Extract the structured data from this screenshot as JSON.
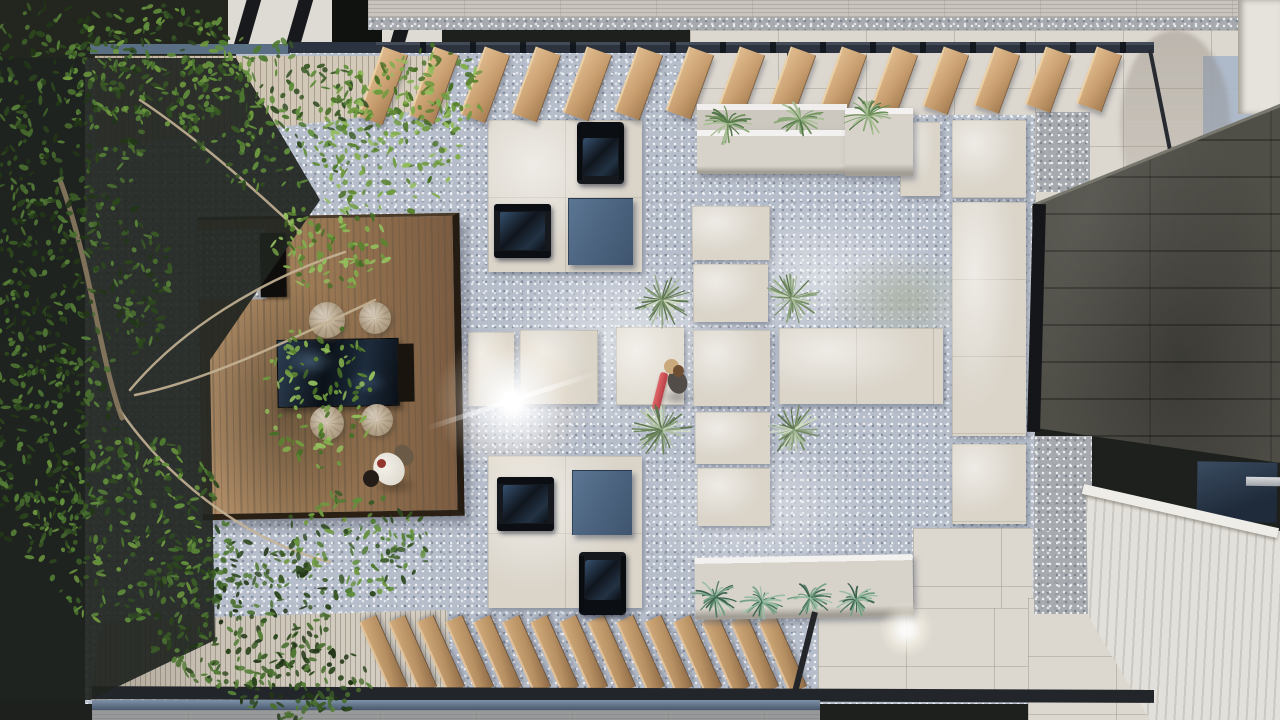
{
  "scene": {
    "type": "architectural-render-top-down",
    "description": "Aerial view of a modern courtyard: wooden dining deck under a large tree, blue-gray gravel garden with concrete pavers, two louvered pergolas, planter benches with ornamental grasses, yucca shrubs, a dark stone roof and white plank ramp on the right, two people.",
    "people": [
      {
        "id": "person-on-deck",
        "appearance": "white long-sleeve top, dark hair, olive trousers",
        "location": "walking on wooden deck"
      },
      {
        "id": "person-on-path",
        "appearance": "dark top, light sun hat, carrying a red rolled mat",
        "location": "standing on central paver path"
      }
    ],
    "furniture": {
      "deck_table": "dark reflective low dining table",
      "pouf_count": 4,
      "lounge_chair_count": 2,
      "club_chair_count": 2,
      "slate_side_table_count": 2,
      "bench_count": 2
    }
  },
  "palette": {
    "underDark": "#1d201c",
    "gravel": "#b7becb",
    "gravelDark": "#a6a9ad",
    "paver": "#dad4c9",
    "tile": "#dcd7cf",
    "tileBlue": "#a9b6c8",
    "tileBlue2": "#9dafc6",
    "woodDeckL": "#b28f69",
    "woodDeckD": "#7c5c41",
    "woodSlat": "#cda87c",
    "woodPale": "#cfc4b2",
    "deckGray": "#c9c2b5",
    "steel": "#2f3642",
    "beamDark": "#22252a",
    "roof": "#4f4e47",
    "navy": "#101b26",
    "slateTable": "#4e6682",
    "pouf": "#c3b299",
    "bench": "#d7d3cb",
    "white": "#e6e3dd",
    "glassBlue": "#6d8099",
    "shirt": "#ece8e1",
    "redItem": "#cc4f55"
  },
  "pergola_top": {
    "slat_count": 15,
    "lean_deg": 20,
    "x": 382,
    "y": 51,
    "spacing": 51,
    "width": 27,
    "len0": 74,
    "dlen": 1.0
  },
  "pergola_bottom": {
    "slat_count": 15,
    "lean_deg": -24,
    "x": 390,
    "y": 690,
    "spacing": 28.5,
    "width": 19,
    "len": 78
  },
  "poufs": [
    [
      327,
      320,
      18
    ],
    [
      375,
      318,
      16
    ],
    [
      327,
      423,
      17
    ],
    [
      377,
      420,
      16
    ]
  ],
  "vegetation": {
    "yuccas": [
      [
        662,
        300,
        30
      ],
      [
        792,
        298,
        27
      ],
      [
        662,
        430,
        30
      ],
      [
        794,
        430,
        27
      ]
    ],
    "grass_top": [
      [
        728,
        124,
        26
      ],
      [
        800,
        120,
        26
      ],
      [
        868,
        116,
        26
      ]
    ],
    "grass_bottom": [
      [
        715,
        598,
        24
      ],
      [
        762,
        602,
        24
      ],
      [
        810,
        598,
        24
      ],
      [
        856,
        600,
        22
      ]
    ],
    "foliage_clusters": [
      [
        55,
        115,
        95,
        115,
        260,
        "dark"
      ],
      [
        160,
        65,
        95,
        60,
        200,
        "mid"
      ],
      [
        275,
        115,
        95,
        75,
        200,
        "mid"
      ],
      [
        390,
        140,
        70,
        80,
        130,
        "sun"
      ],
      [
        75,
        285,
        100,
        95,
        260,
        "dark"
      ],
      [
        35,
        440,
        85,
        105,
        240,
        "dark"
      ],
      [
        125,
        530,
        105,
        95,
        260,
        "mid"
      ],
      [
        235,
        615,
        95,
        75,
        220,
        "dark"
      ],
      [
        320,
        395,
        55,
        75,
        100,
        "sun"
      ],
      [
        330,
        245,
        60,
        45,
        90,
        "sun"
      ],
      [
        355,
        545,
        75,
        55,
        120,
        "mid"
      ],
      [
        295,
        680,
        80,
        40,
        120,
        "dark"
      ],
      [
        430,
        90,
        55,
        45,
        80,
        "sun"
      ]
    ],
    "branches": [
      "M130,390 C180,330 260,280 345,252",
      "M135,395 C210,380 300,335 375,300",
      "M120,410 C160,470 240,540 330,562",
      "M140,100 C200,140 255,190 300,232",
      "M60,180 C90,260 100,360 122,418"
    ]
  },
  "seed": 42
}
